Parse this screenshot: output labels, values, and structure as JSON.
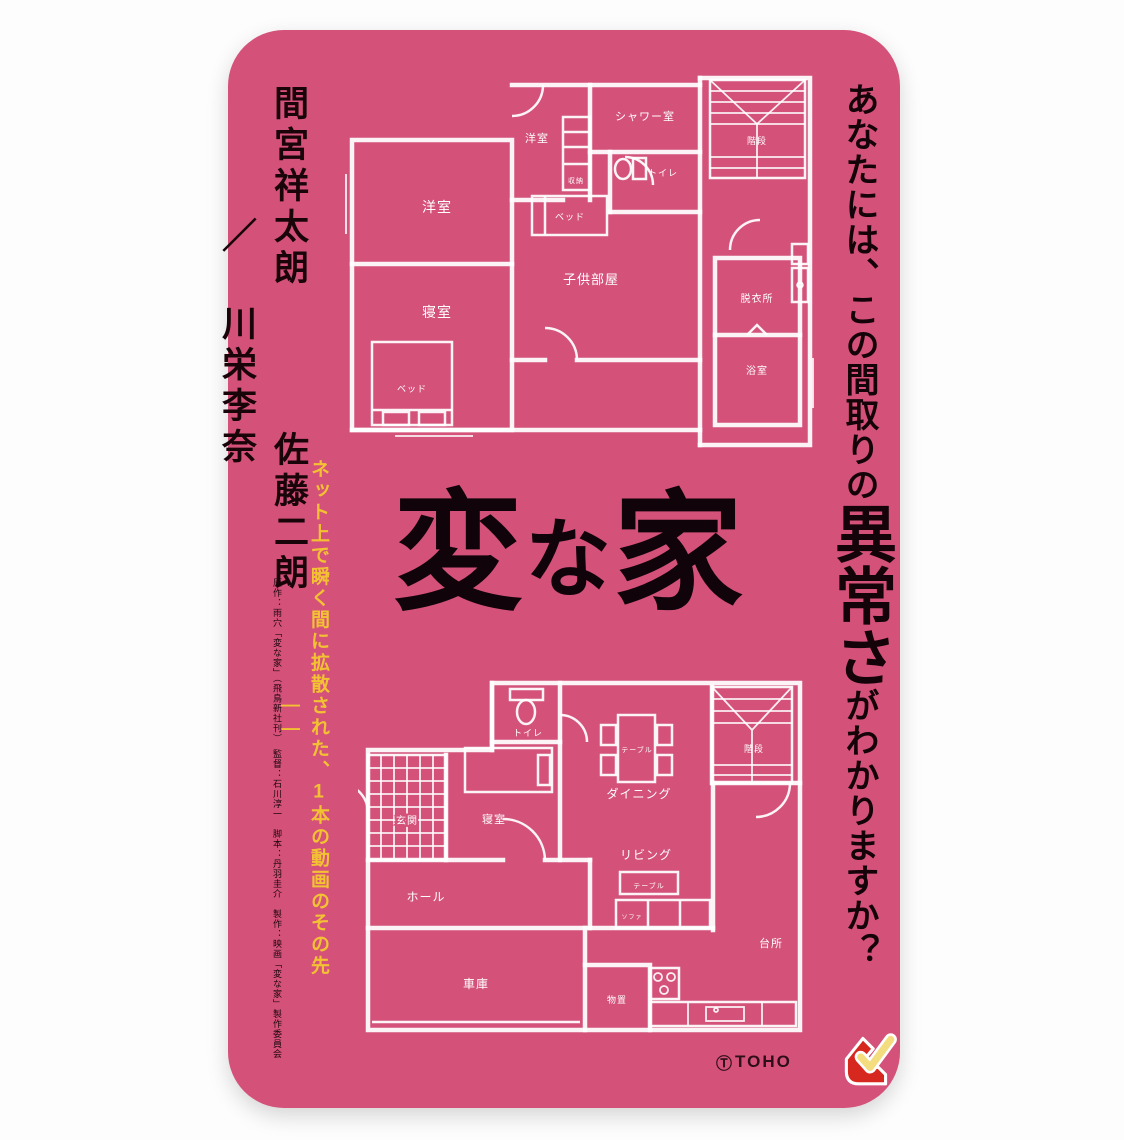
{
  "colors": {
    "card_bg": "#d4517a",
    "plan_line": "#ffffff",
    "tagline_ink": "#140308",
    "copy_yellow": "#f2c233",
    "logo_red": "#d6281e",
    "check_yellow": "#ffe98a"
  },
  "card": {
    "title": {
      "full": "変な家",
      "char1": "変",
      "char2": "な",
      "char3": "家"
    },
    "tagline_right": {
      "pre": "あなたには、この間取りの",
      "emphasis": "異常さ",
      "post": "がわかりますか？"
    },
    "cast": [
      "間宮祥太朗",
      "佐藤二朗",
      "川栄李奈"
    ],
    "cast_separator": "／",
    "tagline_yellow": "ネット上で瞬く間に拡散された、1本の動画のその先――",
    "credits": "原作：雨穴「変な家」（飛鳥新社刊）　監督：石川淳一　脚本：丹羽圭介　製作：映画「変な家」製作委員会",
    "logos": {
      "toho_mark": "Ⓣ",
      "toho_text": "TOHO",
      "movieticket": "movieticket-check-logo"
    }
  },
  "plan2f": {
    "name": "二階間取り図",
    "labels": {
      "yoshitsu_main": "洋室",
      "shinshitsu": "寝室",
      "bed_main": "ベッド",
      "yoshitsu_small": "洋室",
      "shunou": "収納",
      "shower": "シャワー室",
      "toilet": "トイレ",
      "bed_small": "ベッド",
      "kodomo": "子供部屋",
      "kaidan": "階段",
      "datsuisho": "脱衣所",
      "yokushitsu": "浴室"
    }
  },
  "plan1f": {
    "name": "一階間取り図",
    "labels": {
      "toilet": "トイレ",
      "table_dining": "テーブル",
      "dining": "ダイニング",
      "kaidan": "階段",
      "genkan": "玄関",
      "shinshitsu": "寝室",
      "hall": "ホール",
      "living": "リビング",
      "table_living": "テーブル",
      "sofa": "ソファ",
      "daidokoro": "台所",
      "monooki": "物置",
      "shako": "車庫"
    }
  }
}
